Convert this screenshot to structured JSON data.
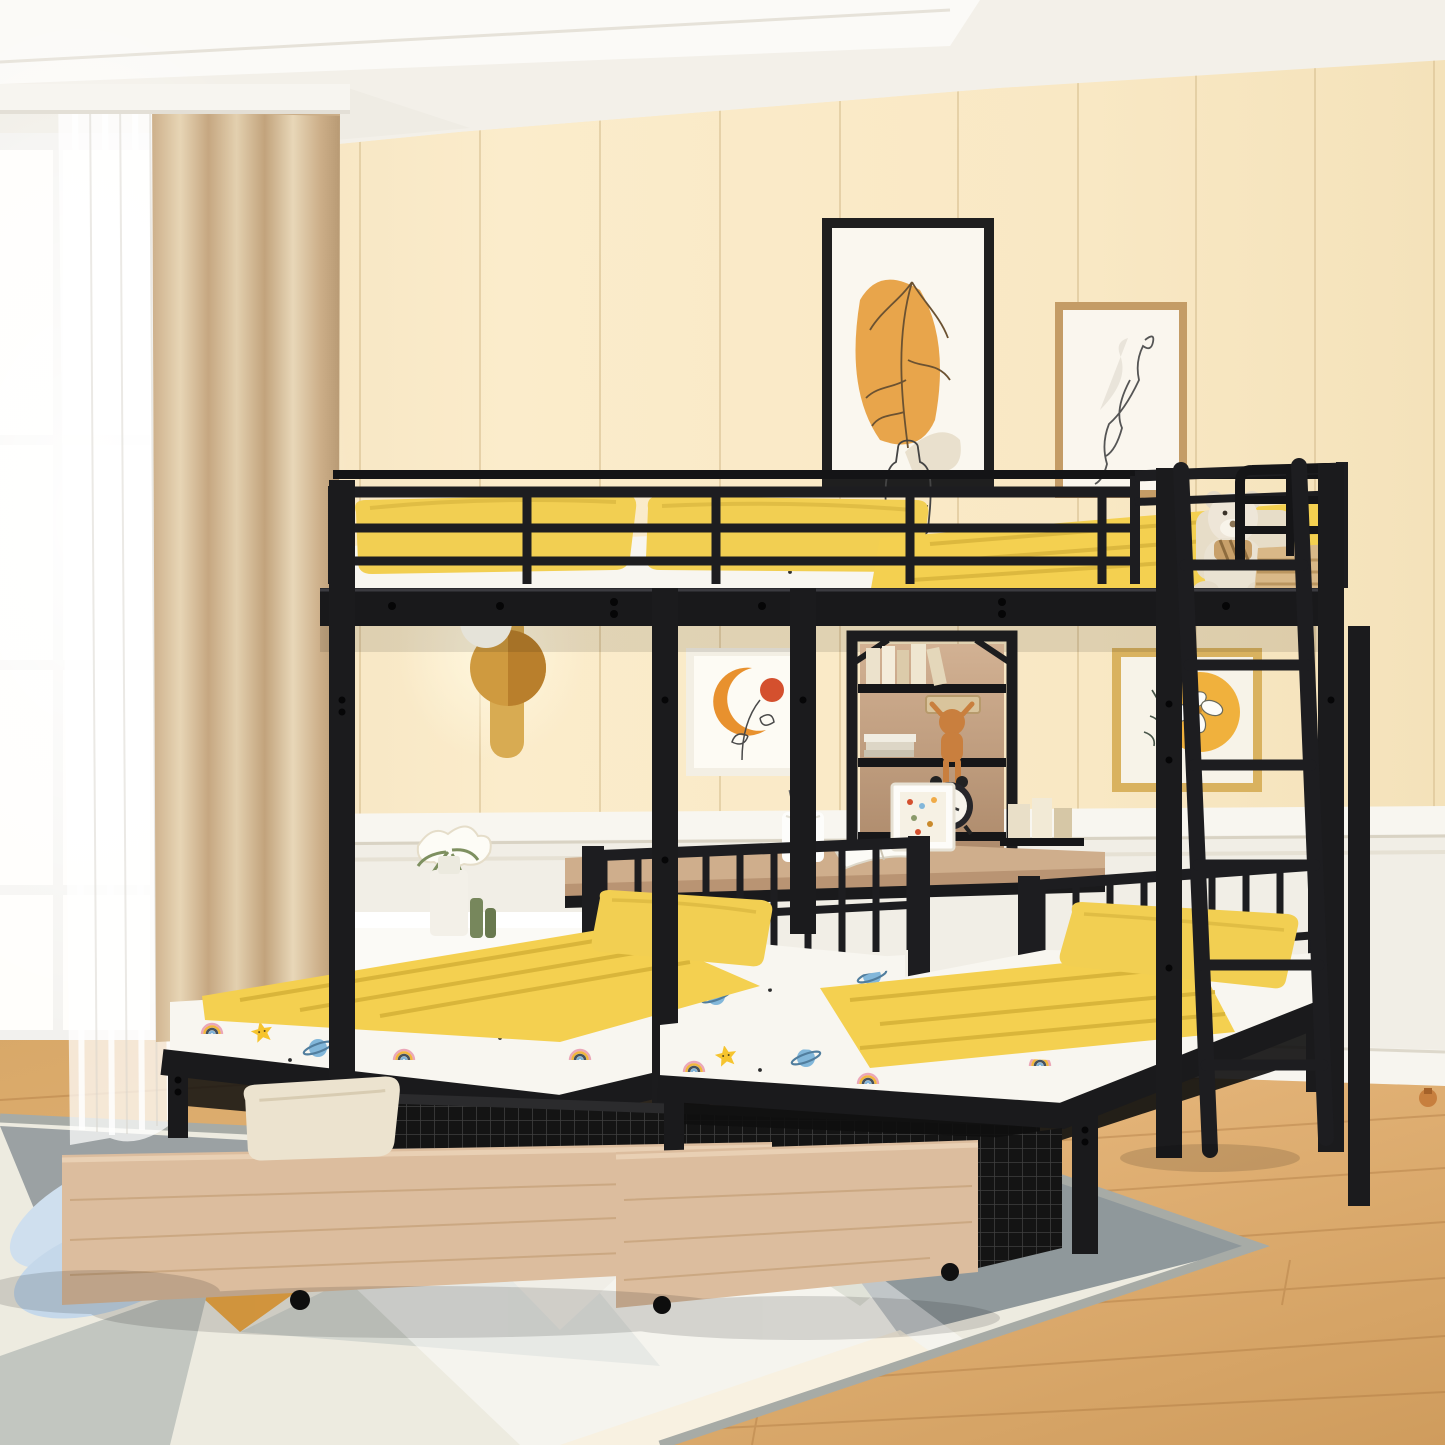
{
  "scene": {
    "type": "product-photo",
    "description": "Black metal triple bunk bed: full-size loft bed on top over two twin beds with under-bed storage drawers, central shelf-and-desk tower and side ladder, staged in a cream panelled kids bedroom",
    "room": {
      "wall": "cream vertical panelling",
      "wainscoting": "white with chair rail",
      "ceiling": "white tray ceiling",
      "floor": "light oak plank",
      "rug": "geometric triangles in gray, cream, sage and amber",
      "window": "white framed window with sheer curtain",
      "curtain": "beige linen drape"
    },
    "objects": [
      {
        "name": "triple-bunk-bed-frame",
        "material": "black metal",
        "color": "#1d1d20"
      },
      {
        "name": "upper-full-bed",
        "bedding": [
          "yellow pillows",
          "white star-planet sheet",
          "yellow blanket"
        ]
      },
      {
        "name": "upper-guard-rails",
        "color": "#1d1d20"
      },
      {
        "name": "teddy-bear",
        "color": "#ece4d6",
        "accessory": "striped bow scarf"
      },
      {
        "name": "wicker-basket",
        "color": "#d9b887"
      },
      {
        "name": "shelf-tower",
        "back": "wood",
        "contents": [
          "books",
          "white box stack",
          "plush-toy",
          "alarm-clock"
        ]
      },
      {
        "name": "desk",
        "top": "wood",
        "items": [
          "pen-cup",
          "open-book",
          "photo-frame"
        ]
      },
      {
        "name": "left-twin-bed",
        "bedding": [
          "yellow pillow",
          "yellow blanket",
          "star-planet fitted sheet"
        ]
      },
      {
        "name": "right-twin-bed",
        "bedding": [
          "yellow pillow",
          "yellow blanket",
          "star-planet fitted sheet"
        ]
      },
      {
        "name": "storage-drawer-left",
        "front": "natural wood",
        "sides": "black wire mesh",
        "contents": "white blanket",
        "wheels": "black casters"
      },
      {
        "name": "storage-drawer-right",
        "front": "natural wood",
        "sides": "black wire mesh",
        "wheels": "black casters"
      },
      {
        "name": "ladder",
        "color": "#1d1d20",
        "position": "right"
      },
      {
        "name": "cream-throw-pillow",
        "color": "#ece3cf"
      },
      {
        "name": "nightstand",
        "color": "#fbfaf6",
        "items": [
          "white flowers",
          "geometric vase",
          "green candlesticks"
        ]
      },
      {
        "name": "wall-art-plant-poster",
        "frame": "black",
        "art": "orange blob with line-art leaves in bottle"
      },
      {
        "name": "wall-art-figure-poster",
        "frame": "tan wood",
        "art": "one-line figure drawing"
      },
      {
        "name": "wall-art-moon-poster",
        "frame": "cream",
        "art": "orange crescent moon, red dot, line flowers"
      },
      {
        "name": "wall-art-flower-poster",
        "frame": "gold",
        "art": "white flower over amber circle"
      },
      {
        "name": "wall-lamp",
        "color": "#d8ab52",
        "state": "lit"
      },
      {
        "name": "plush-slippers",
        "color": "#cfdfee"
      }
    ],
    "palette": {
      "metal_black": "#1d1d20",
      "wall_cream": "#f8e9c9",
      "panel_line": "#d9c193",
      "wainscot_white": "#f1eee6",
      "floor_oak": "#dcaa6b",
      "curtain_beige": "#d6bd9d",
      "bedding_yellow": "#f2cf52",
      "sheet_white": "#f8f6f0",
      "drawer_wood": "#dcbd9e",
      "desk_wood": "#cfae8c",
      "rug_gray": "#9ba1a3",
      "rug_amber": "#f0ab47",
      "star_yellow": "#f6c42e",
      "planet_blue": "#82b7da",
      "slipper_blue": "#cfdfee",
      "art_orange": "#e8a54b",
      "art_red": "#d4502e"
    }
  }
}
